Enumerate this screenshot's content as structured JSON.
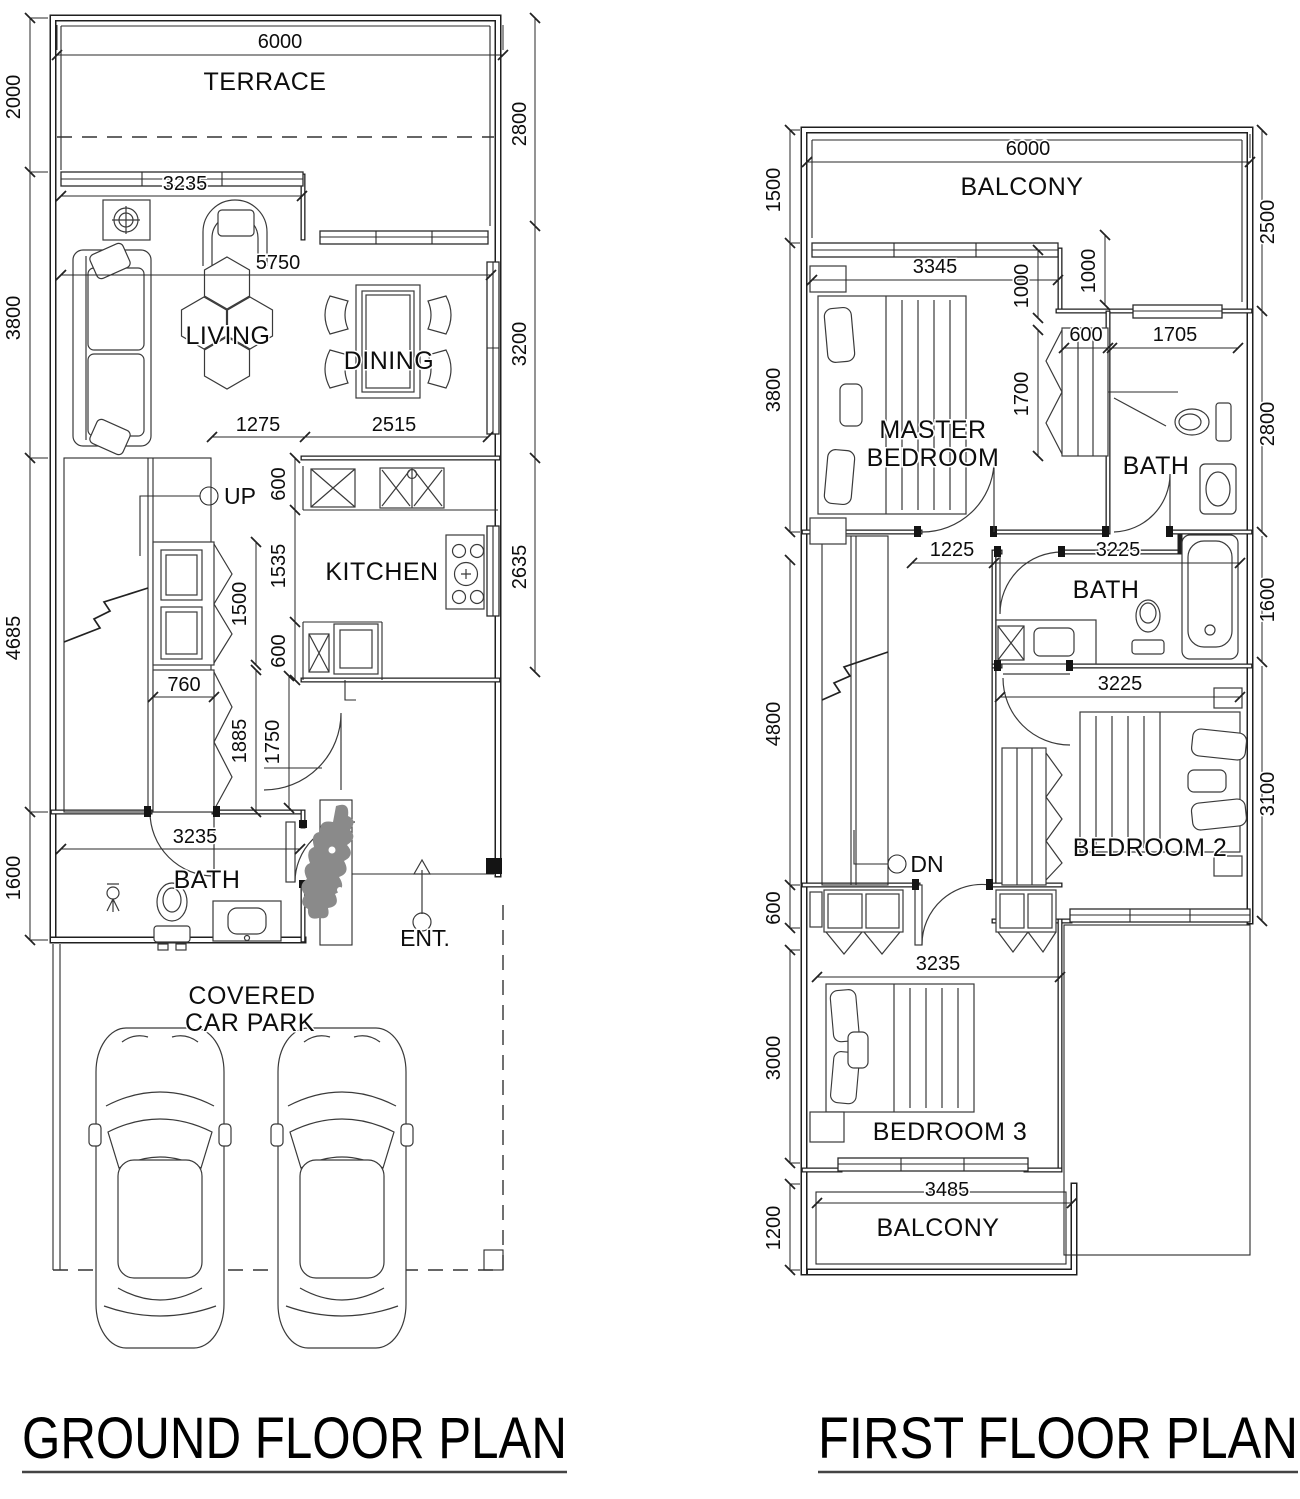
{
  "titles": {
    "ground": "GROUND FLOOR PLAN",
    "first": "FIRST FLOOR PLAN"
  },
  "gf": {
    "rooms": {
      "terrace": "TERRACE",
      "living": "LIVING",
      "dining": "DINING",
      "kitchen": "KITCHEN",
      "bath": "BATH",
      "carpark1": "COVERED",
      "carpark2": "CAR PARK"
    },
    "ann": {
      "up": "UP",
      "ent": "ENT."
    },
    "dims": {
      "w6000": "6000",
      "h2000": "2000",
      "h3800": "3800",
      "h4685": "4685",
      "h1600": "1600",
      "r2800": "2800",
      "r3200": "3200",
      "r2635": "2635",
      "w3235t": "3235",
      "w5750": "5750",
      "w1275": "1275",
      "w2515": "2515",
      "k600a": "600",
      "k1535": "1535",
      "k600b": "600",
      "c1500": "1500",
      "c760": "760",
      "c1885": "1885",
      "c1750": "1750",
      "w3235b": "3235"
    }
  },
  "ff": {
    "rooms": {
      "balcony_top": "BALCONY",
      "master1": "MASTER",
      "master2": "BEDROOM",
      "bath1": "BATH",
      "bath2": "BATH",
      "bedroom2": "BEDROOM 2",
      "bedroom3": "BEDROOM 3",
      "balcony_bottom": "BALCONY"
    },
    "ann": {
      "dn": "DN"
    },
    "dims": {
      "w6000": "6000",
      "h1500": "1500",
      "h3800": "3800",
      "h4800": "4800",
      "h600": "600",
      "h3000": "3000",
      "h1200": "1200",
      "r2500": "2500",
      "r2800": "2800",
      "r1600": "1600",
      "r3100": "3100",
      "w3345": "3345",
      "v1000a": "1000",
      "v1000b": "1000",
      "c600": "600",
      "w1705": "1705",
      "v1700": "1700",
      "w1225": "1225",
      "w3225a": "3225",
      "w3225b": "3225",
      "w3235": "3235",
      "w3485": "3485"
    }
  }
}
